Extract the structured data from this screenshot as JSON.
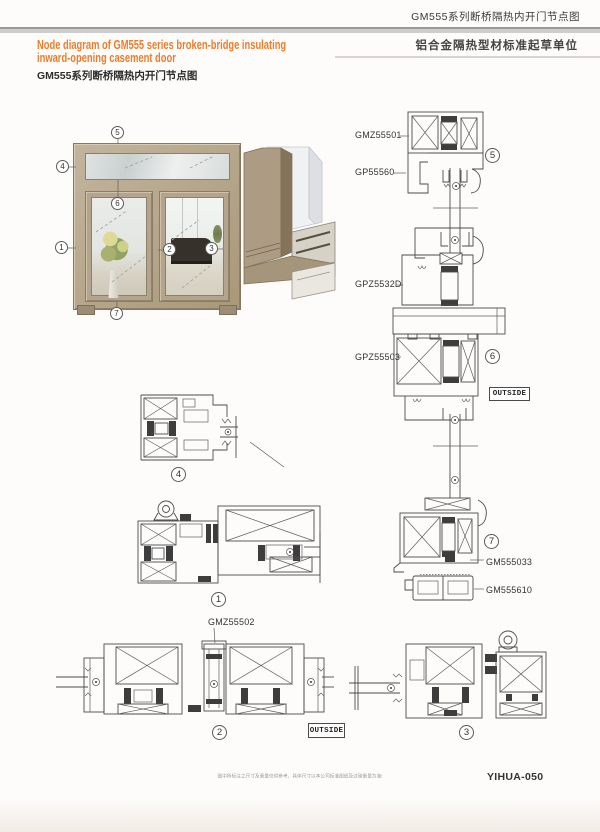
{
  "header": {
    "right_title": "GM555系列断桥隔热内开门节点图",
    "right_subtitle": "铝合金隔热型材标准起草单位",
    "en_line1": "Node diagram of GM555 series broken-bridge insulating",
    "en_line2": "inward-opening casement door",
    "left_title": "GM555系列断桥隔热内开门节点图"
  },
  "part_labels": {
    "gmz55501": "GMZ55501",
    "gp55560": "GP55560",
    "gpz5532d": "GPZ5532D",
    "gpz55503": "GPZ55503",
    "gm555033": "GM555033",
    "gm555610": "GM555610",
    "gmz55502": "GMZ55502"
  },
  "outside_label": "OUTSIDE",
  "markers": {
    "n1": "1",
    "n2": "2",
    "n3": "3",
    "n4": "4",
    "n5": "5",
    "n6": "6",
    "n7": "7"
  },
  "footer": {
    "note": "图中所标注之尺寸及重量仅供参考，具体尺寸以本公司标准图纸及过磅重量为准!",
    "code": "YIHUA-050"
  },
  "colors": {
    "accent": "#ed7d2b",
    "frame_tan": "#b4a48e"
  }
}
